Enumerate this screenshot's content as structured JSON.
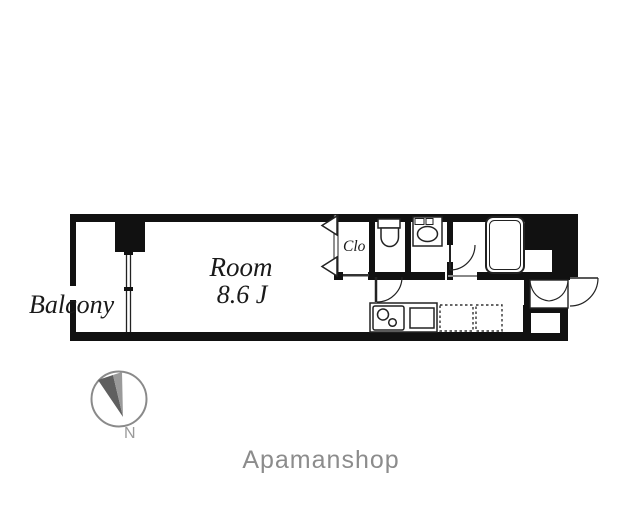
{
  "plan": {
    "balcony_label": "Balcony",
    "room_label": "Room",
    "room_size_label": "8.6 J",
    "closet_label": "Clo"
  },
  "compass": {
    "north_label": "N"
  },
  "footer": {
    "brand_label": "Apamanshop"
  },
  "colors": {
    "wall": "#111111",
    "line": "#222222",
    "label_text": "#1a1a1a",
    "muted_gray": "#8c8c8c",
    "compass_ring": "#8a8a8a",
    "needle_dark": "#5f5f5f",
    "needle_light": "#9a9a9a"
  },
  "fixtures": [
    "bathtub-icon",
    "toilet-icon",
    "washbasin-icon",
    "stove-burners-icon",
    "kitchen-sink-icon",
    "shoe-cabinet-icon",
    "folding-closet-door-icon",
    "balcony-window-icon",
    "door-swing-arc",
    "compass-needle-icon"
  ]
}
